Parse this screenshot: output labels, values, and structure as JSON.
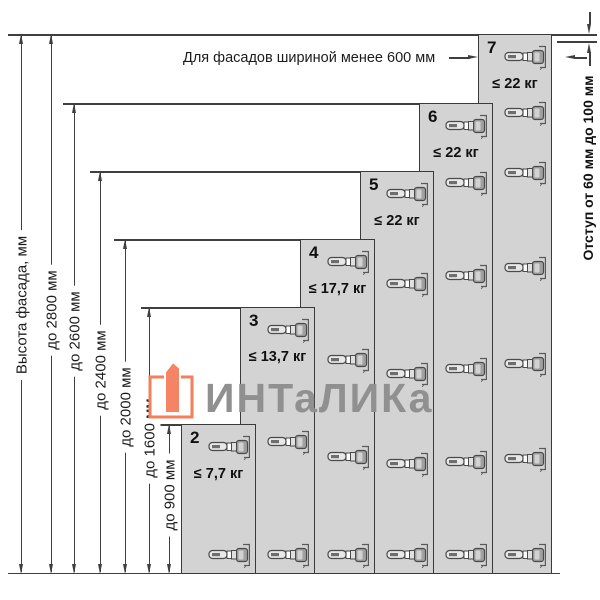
{
  "notes": {
    "top": "Для фасадов шириной менее 600 мм",
    "right": "Отступ от 60 мм до 100 мм"
  },
  "dimension_labels": {
    "facade": "Высота фасада, мм",
    "h2800": "до 2800 мм",
    "h2600": "до 2600 мм",
    "h2400": "до 2400 мм",
    "h2000": "до 2000 мм",
    "h1600": "до 1600 мм",
    "h900": "до 900 мм"
  },
  "columns": [
    {
      "number": "2",
      "weight": "≤ 7,7 кг",
      "max_height": "до 900 мм",
      "hinge_count": 2
    },
    {
      "number": "3",
      "weight": "≤ 13,7 кг",
      "max_height": "до 1600 мм",
      "hinge_count": 3
    },
    {
      "number": "4",
      "weight": "≤ 17,7 кг",
      "max_height": "до 2000 мм",
      "hinge_count": 4
    },
    {
      "number": "5",
      "weight": "≤ 22 кг",
      "max_height": "до 2400 мм",
      "hinge_count": 5
    },
    {
      "number": "6",
      "weight": "≤ 22 кг",
      "max_height": "до 2600 мм",
      "hinge_count": 6
    },
    {
      "number": "7",
      "weight": "≤ 22 кг",
      "max_height": "до 2800 мм",
      "hinge_count": 7
    }
  ],
  "watermark": {
    "text": "ИНТаЛИКа"
  },
  "icons": {
    "hinge": "concealed-cabinet-hinge-side-view"
  },
  "colors": {
    "panel_fill": "#d3d3d3",
    "line": "#3f3f3f",
    "accent_orange": "#f2805a",
    "watermark_gray": "#909090"
  }
}
